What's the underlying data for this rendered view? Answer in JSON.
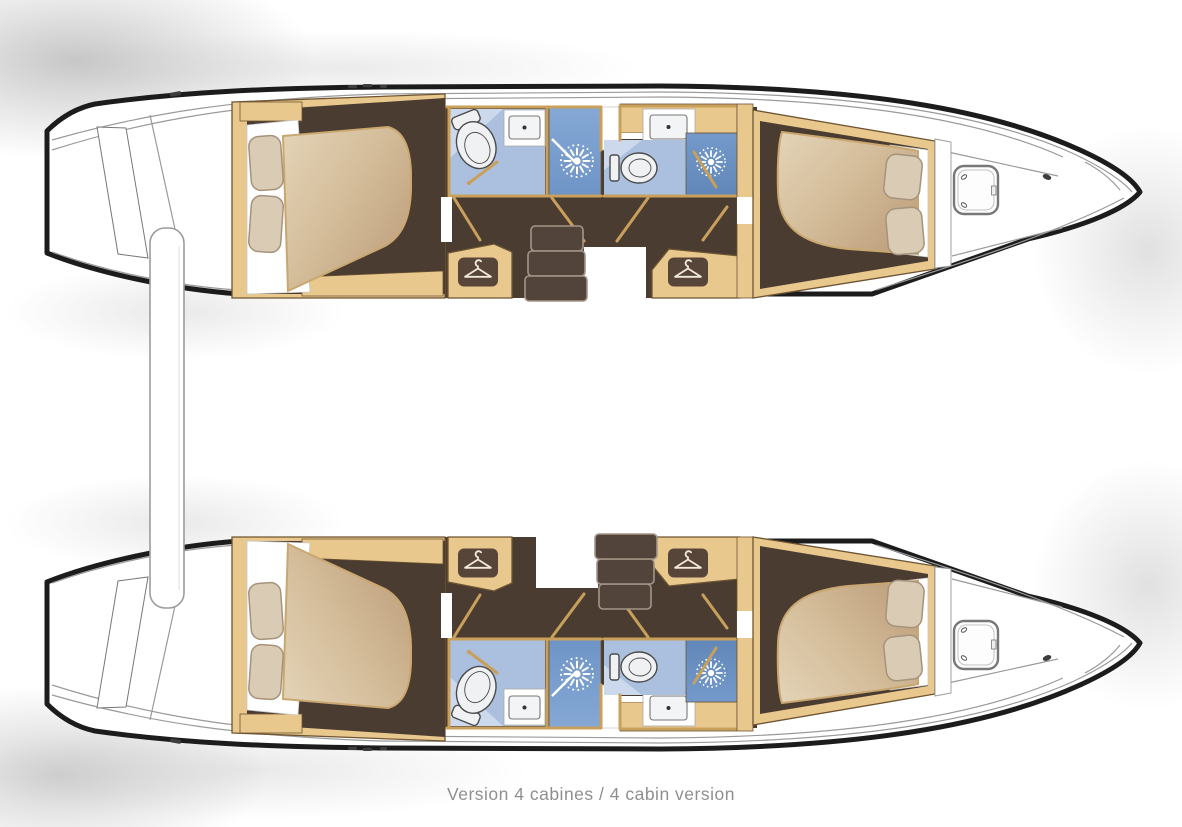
{
  "caption": {
    "text": "Version 4 cabines / 4 cabin version"
  },
  "plan": {
    "type": "catamaran-floor-plan-top-view",
    "cabins_total": 4,
    "hulls": [
      {
        "id": "upper-hull",
        "rooms": [
          "aft-cabin-double-bed",
          "aft-head-toilet-washbasin",
          "aft-shower",
          "wardrobe-aft",
          "companionway-stairs",
          "forward-head-toilet-washbasin",
          "forward-shower",
          "wardrobe-forward",
          "forward-cabin-double-bed",
          "forepeak-deck-hatch"
        ]
      },
      {
        "id": "lower-hull",
        "rooms": [
          "aft-cabin-double-bed",
          "aft-head-toilet-washbasin",
          "aft-shower",
          "wardrobe-aft",
          "companionway-stairs",
          "forward-head-toilet-washbasin",
          "forward-shower",
          "wardrobe-forward",
          "forward-cabin-double-bed",
          "forepeak-deck-hatch"
        ]
      }
    ]
  },
  "icons": {
    "hanger": "hanger-icon",
    "shower": "shower-spray-starburst-icon",
    "toilet": "toilet-icon",
    "washbasin": "washbasin-icon",
    "hatch": "deck-hatch-icon"
  },
  "colors": {
    "outline": "#1c1c1c",
    "deckLine": "#9a9a9a",
    "wood": "#e9c88e",
    "woodDark": "#6e5532",
    "wallWood": "#c8a05c",
    "floor": "#4b3c31",
    "stair": "#53443b",
    "stairEdge": "#a39588",
    "mattressLight": "#e4d4b8",
    "mattressMid": "#d4bd9a",
    "mattressDark": "#bfa07d",
    "mattressEdge": "#c9a76f",
    "pillow": "#d9cbb4",
    "pillowEdge": "#a5937c",
    "linen": "#ffffff",
    "bathFloor": "#abc0de",
    "bathLight": "#ccd9ec",
    "showerTop": "#85a8d5",
    "showerBottom": "#6e94c6",
    "showerDeepTop": "#7499cb",
    "showerDeepBottom": "#6186b8",
    "fixture": "#f0f1f3",
    "fixtureLine": "#4a4a4a",
    "hangerPanel": "#57453a",
    "hangerGlyph": "#f2e9d8",
    "hatchLine": "#787878",
    "platformEdge": "#9c9c9c",
    "shadow": "#8f8f8f",
    "caption": "#8f8f8f"
  }
}
